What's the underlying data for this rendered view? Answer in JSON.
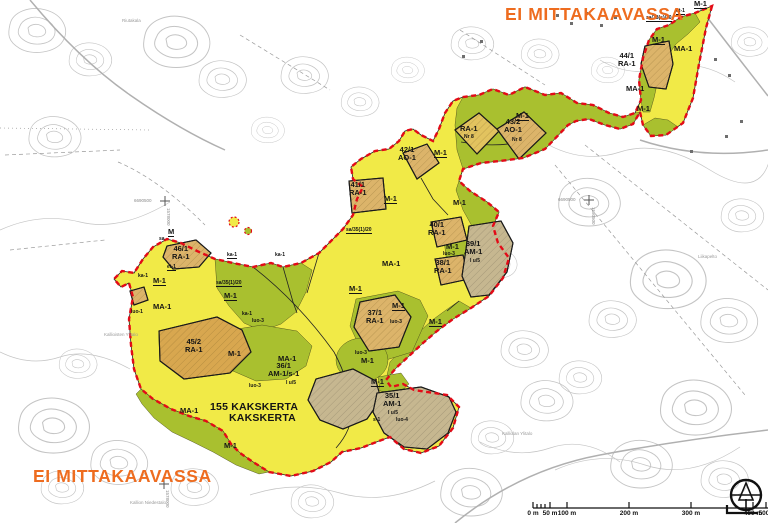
{
  "headings": {
    "not_to_scale_top": "EI MITTAKAAVASSA",
    "not_to_scale_bottom": "EI MITTAKAAVASSA"
  },
  "district": {
    "number_line": "155 KAKSKERTA",
    "name_line": "KAKSKERTA"
  },
  "colors": {
    "agriculture_area_ma1": "#f1ea47",
    "forestry_area_m1": "#a9c02f",
    "holiday_parcel_tan": "#dcb46a",
    "farm_parcel_gray": "#c6b790",
    "parcel_45_orange": "#d8a74f",
    "plan_boundary_red": "#e30b17",
    "heading_orange": "#ee6c1f",
    "contour_gray": "#c4c4c4"
  },
  "map_labels": [
    {
      "name": "zone-label-m1-ne-tip",
      "text": "M-1",
      "x": 694,
      "y": 0,
      "cls": "zu"
    },
    {
      "name": "zone-label-et1-ne",
      "text": "et-1",
      "x": 676,
      "y": 9,
      "cls": "tu"
    },
    {
      "name": "zone-label-sa38",
      "text": "sa/38(s)/20",
      "x": 646,
      "y": 16,
      "cls": "tu"
    },
    {
      "name": "zone-label-m1-blob-w",
      "text": "M-1",
      "x": 652,
      "y": 36,
      "cls": "zu"
    },
    {
      "name": "zone-label-ma1-blob",
      "text": "MA-1",
      "x": 674,
      "y": 45,
      "cls": "z"
    },
    {
      "name": "parcel-label-44-ra1",
      "text": "44/1\nRA-1",
      "x": 618,
      "y": 52,
      "cls": "p"
    },
    {
      "name": "zone-label-ma1-mid-blob",
      "text": "MA-1",
      "x": 626,
      "y": 85,
      "cls": "z"
    },
    {
      "name": "zone-label-m1-blob-s",
      "text": "M-1",
      "x": 637,
      "y": 105,
      "cls": "z"
    },
    {
      "name": "zone-label-m1-band",
      "text": "M-1",
      "x": 516,
      "y": 112,
      "cls": "zu"
    },
    {
      "name": "parcel-label-ra1-nr8",
      "text": "RA-1",
      "x": 460,
      "y": 125,
      "cls": "p"
    },
    {
      "name": "parcel-sub-nr8-a",
      "text": "Nr 8",
      "x": 464,
      "y": 135,
      "cls": "t"
    },
    {
      "name": "parcel-label-43-ao1",
      "text": "43/2\nAO-1",
      "x": 504,
      "y": 118,
      "cls": "p"
    },
    {
      "name": "parcel-sub-nr8-b",
      "text": "Nr 8",
      "x": 512,
      "y": 138,
      "cls": "t"
    },
    {
      "name": "parcel-label-42-ao1",
      "text": "42/1\nAO-1",
      "x": 398,
      "y": 146,
      "cls": "p"
    },
    {
      "name": "zone-label-m1-42",
      "text": "M-1",
      "x": 434,
      "y": 149,
      "cls": "zu"
    },
    {
      "name": "parcel-label-41-ra1",
      "text": "41/1\nRA-1",
      "x": 349,
      "y": 181,
      "cls": "p"
    },
    {
      "name": "zone-label-m1-41",
      "text": "M-1",
      "x": 384,
      "y": 195,
      "cls": "zu"
    },
    {
      "name": "zone-label-m1-e",
      "text": "M-1",
      "x": 453,
      "y": 199,
      "cls": "z"
    },
    {
      "name": "zone-label-sa35-e",
      "text": "sa/35(1)/20",
      "x": 346,
      "y": 228,
      "cls": "tu"
    },
    {
      "name": "parcel-label-40-ra1",
      "text": "40/1\nRA-1",
      "x": 428,
      "y": 221,
      "cls": "p"
    },
    {
      "name": "zone-label-m1-40s",
      "text": "M-1",
      "x": 446,
      "y": 243,
      "cls": "z"
    },
    {
      "name": "zone-label-luo3-40s",
      "text": "luo-3",
      "x": 443,
      "y": 252,
      "cls": "t"
    },
    {
      "name": "parcel-label-39-am1",
      "text": "39/1\nAM-1",
      "x": 464,
      "y": 240,
      "cls": "p"
    },
    {
      "name": "parcel-sub-39",
      "text": "I u/5",
      "x": 470,
      "y": 259,
      "cls": "t"
    },
    {
      "name": "parcel-label-38-ra1",
      "text": "38/1\nRA-1",
      "x": 434,
      "y": 259,
      "cls": "p"
    },
    {
      "name": "zone-label-ma1-central",
      "text": "MA-1",
      "x": 382,
      "y": 260,
      "cls": "z"
    },
    {
      "name": "zone-label-m-w",
      "text": "M",
      "x": 168,
      "y": 228,
      "cls": "zu"
    },
    {
      "name": "zone-label-sa-w",
      "text": "sa",
      "x": 159,
      "y": 237,
      "cls": "t"
    },
    {
      "name": "parcel-label-46-ra1",
      "text": "46/1\nRA-1",
      "x": 172,
      "y": 245,
      "cls": "p"
    },
    {
      "name": "zone-label-ka1-a",
      "text": "ka-1",
      "x": 227,
      "y": 253,
      "cls": "tu"
    },
    {
      "name": "zone-label-ka1-b",
      "text": "ka-1",
      "x": 275,
      "y": 253,
      "cls": "t"
    },
    {
      "name": "zone-label-et1-w",
      "text": "et-1",
      "x": 167,
      "y": 265,
      "cls": "tu"
    },
    {
      "name": "zone-label-ka1-c",
      "text": "ka-1",
      "x": 138,
      "y": 274,
      "cls": "t"
    },
    {
      "name": "zone-label-m1-w",
      "text": "M-1",
      "x": 153,
      "y": 277,
      "cls": "zu"
    },
    {
      "name": "zone-label-sa35-w",
      "text": "sa/35(1)/20",
      "x": 216,
      "y": 281,
      "cls": "tu"
    },
    {
      "name": "zone-label-m1-nw",
      "text": "M-1",
      "x": 224,
      "y": 292,
      "cls": "zu"
    },
    {
      "name": "zone-label-ma1-w",
      "text": "MA-1",
      "x": 153,
      "y": 303,
      "cls": "z"
    },
    {
      "name": "zone-label-luo1-w",
      "text": "luo-1",
      "x": 131,
      "y": 310,
      "cls": "t"
    },
    {
      "name": "zone-label-ka1-d",
      "text": "ka-1",
      "x": 242,
      "y": 312,
      "cls": "t"
    },
    {
      "name": "zone-label-luo3-c",
      "text": "luo-3",
      "x": 252,
      "y": 319,
      "cls": "t"
    },
    {
      "name": "parcel-label-45-ra1",
      "text": "45/2\nRA-1",
      "x": 185,
      "y": 338,
      "cls": "p"
    },
    {
      "name": "zone-label-m1-45e",
      "text": "M-1",
      "x": 228,
      "y": 350,
      "cls": "z"
    },
    {
      "name": "zone-label-luo3-s",
      "text": "luo-3",
      "x": 249,
      "y": 384,
      "cls": "t"
    },
    {
      "name": "zone-label-m1-coast-a",
      "text": "M-1",
      "x": 349,
      "y": 285,
      "cls": "zu"
    },
    {
      "name": "zone-label-m1-coast-b",
      "text": "M-1",
      "x": 392,
      "y": 302,
      "cls": "zu"
    },
    {
      "name": "parcel-label-37-ra1",
      "text": "37/1\nRA-1",
      "x": 366,
      "y": 309,
      "cls": "p"
    },
    {
      "name": "zone-label-luo3-37",
      "text": "luo-3",
      "x": 390,
      "y": 320,
      "cls": "t"
    },
    {
      "name": "zone-label-m1-coast-c",
      "text": "M-1",
      "x": 429,
      "y": 318,
      "cls": "zu"
    },
    {
      "name": "zone-label-luo3-blob",
      "text": "luo-3",
      "x": 355,
      "y": 351,
      "cls": "t"
    },
    {
      "name": "zone-label-m1-blob2",
      "text": "M-1",
      "x": 361,
      "y": 357,
      "cls": "z"
    },
    {
      "name": "zone-label-ma1-sw",
      "text": "MA-1",
      "x": 278,
      "y": 355,
      "cls": "z"
    },
    {
      "name": "parcel-label-36-am1",
      "text": "36/1\nAM-1/s-1",
      "x": 268,
      "y": 362,
      "cls": "p"
    },
    {
      "name": "parcel-sub-36",
      "text": "I u/5",
      "x": 286,
      "y": 381,
      "cls": "t"
    },
    {
      "name": "zone-label-m1-36e",
      "text": "M-1",
      "x": 371,
      "y": 378,
      "cls": "zu"
    },
    {
      "name": "parcel-label-35-am1",
      "text": "35/1\nAM-1",
      "x": 383,
      "y": 392,
      "cls": "p"
    },
    {
      "name": "parcel-sub-35",
      "text": "I u/5",
      "x": 388,
      "y": 411,
      "cls": "t"
    },
    {
      "name": "zone-label-s1-35",
      "text": "s-1",
      "x": 373,
      "y": 418,
      "cls": "t"
    },
    {
      "name": "zone-label-luo4-35",
      "text": "luo-4",
      "x": 396,
      "y": 418,
      "cls": "t"
    },
    {
      "name": "zone-label-ma1-s",
      "text": "MA-1",
      "x": 180,
      "y": 407,
      "cls": "z"
    },
    {
      "name": "district-number",
      "text": "155 KAKSKERTA",
      "x": 210,
      "y": 402,
      "cls": "big"
    },
    {
      "name": "district-name",
      "text": "KAKSKERTA",
      "x": 229,
      "y": 413,
      "cls": "big"
    },
    {
      "name": "zone-label-m1-s",
      "text": "M-1",
      "x": 224,
      "y": 442,
      "cls": "z"
    }
  ],
  "place_names": [
    {
      "text": "Riutakala",
      "x": 122,
      "y": 18
    },
    {
      "text": "Kallioisten Ylitalo",
      "x": 104,
      "y": 332
    },
    {
      "text": "Liikapelto",
      "x": 698,
      "y": 254
    },
    {
      "text": "Kalliolan Ylitalo",
      "x": 502,
      "y": 431
    },
    {
      "text": "Kallion Niedestalo",
      "x": 130,
      "y": 500
    }
  ],
  "grid_coordinates": [
    {
      "text": "6690500",
      "x": 134,
      "y": 198,
      "vertical": false
    },
    {
      "text": "1578000",
      "x": 166,
      "y": 208,
      "vertical": true
    },
    {
      "text": "6690500",
      "x": 558,
      "y": 197,
      "vertical": false
    },
    {
      "text": "1580500",
      "x": 591,
      "y": 207,
      "vertical": true
    },
    {
      "text": "1578000",
      "x": 165,
      "y": 490,
      "vertical": true
    }
  ],
  "scale_bar": {
    "unit_ticks": [
      {
        "label": "0 m",
        "x": 533
      },
      {
        "label": "50 m",
        "x": 550
      },
      {
        "label": "100 m",
        "x": 567
      },
      {
        "label": "200 m",
        "x": 629
      },
      {
        "label": "300 m",
        "x": 691
      },
      {
        "label": "400 m",
        "x": 753
      },
      {
        "label": "500",
        "x": 764
      }
    ]
  },
  "compass": {
    "type": "north-arrow"
  }
}
